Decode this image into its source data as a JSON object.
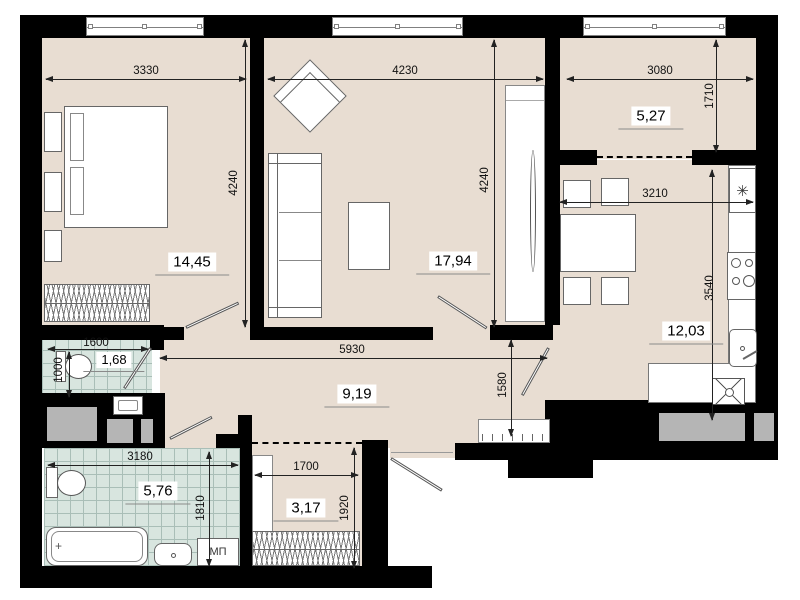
{
  "rooms": {
    "bedroom": {
      "area": "14,45"
    },
    "living_room": {
      "area": "17,94"
    },
    "loggia": {
      "area": "5,27"
    },
    "kitchen": {
      "area": "12,03"
    },
    "wc": {
      "area": "1,68"
    },
    "hallway": {
      "area": "9,19"
    },
    "bathroom": {
      "area": "5,76"
    },
    "wardrobe": {
      "area": "3,17"
    }
  },
  "dims": {
    "bedroom_width": "3330",
    "bedroom_height": "4240",
    "living_width": "4230",
    "living_height": "4240",
    "loggia_width": "3080",
    "loggia_height": "1710",
    "kitchen_width": "3210",
    "kitchen_height": "3540",
    "wc_width": "1600",
    "wc_height": "1000",
    "hall_width": "5930",
    "hall_height": "1580",
    "bathroom_width": "3180",
    "bathroom_height": "1810",
    "wardrobe_width": "1700",
    "wardrobe_height": "1920"
  },
  "labels": {
    "washing_machine": "МП"
  },
  "icons": {
    "fridge_snowflake": "✳",
    "bathtub_drain": "+"
  },
  "colors": {
    "floor": "#e8ddd2",
    "tile": "#d8e5df",
    "wall": "#000000",
    "shaft": "#b5b5b5"
  }
}
